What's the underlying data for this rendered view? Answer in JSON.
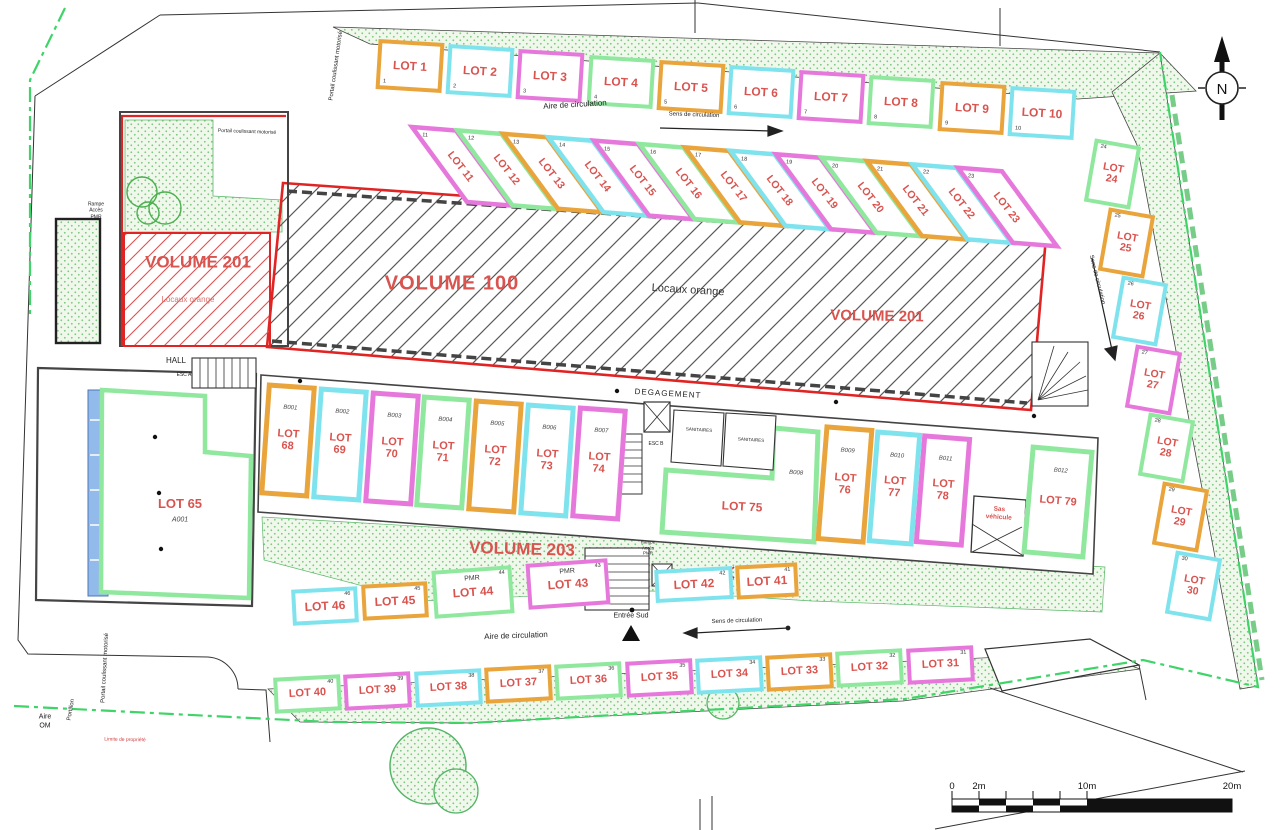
{
  "colors": {
    "orange": "#E9A43C",
    "cyan": "#7FE3EE",
    "magenta": "#E678DC",
    "green": "#8FE89E",
    "lot_text": "#D9534F",
    "red_line": "#E02424",
    "stipple_bg": "#F0F8EC",
    "stipple_dot": "#7CC87F",
    "boundary": "#3FD468",
    "blue": "#7FAEE8",
    "wall": "#3E3E3E"
  },
  "rows": {
    "top": {
      "items": [
        {
          "label": "LOT 1",
          "num": "1",
          "color": "orange"
        },
        {
          "label": "LOT 2",
          "num": "2",
          "color": "cyan"
        },
        {
          "label": "LOT 3",
          "num": "3",
          "color": "magenta"
        },
        {
          "label": "LOT 4",
          "num": "4",
          "color": "green"
        },
        {
          "label": "LOT 5",
          "num": "5",
          "color": "orange"
        },
        {
          "label": "LOT 6",
          "num": "6",
          "color": "cyan"
        },
        {
          "label": "LOT 7",
          "num": "7",
          "color": "magenta"
        },
        {
          "label": "LOT 8",
          "num": "8",
          "color": "green"
        },
        {
          "label": "LOT 9",
          "num": "9",
          "color": "orange"
        },
        {
          "label": "LOT 10",
          "num": "10",
          "color": "cyan"
        }
      ]
    },
    "diagonal": {
      "items": [
        {
          "label": "LOT 11",
          "num": "11",
          "color": "magenta"
        },
        {
          "label": "LOT 12",
          "num": "12",
          "color": "green"
        },
        {
          "label": "LOT 13",
          "num": "13",
          "color": "orange"
        },
        {
          "label": "LOT 14",
          "num": "14",
          "color": "cyan"
        },
        {
          "label": "LOT 15",
          "num": "15",
          "color": "magenta"
        },
        {
          "label": "LOT 16",
          "num": "16",
          "color": "green"
        },
        {
          "label": "LOT 17",
          "num": "17",
          "color": "orange"
        },
        {
          "label": "LOT 18",
          "num": "18",
          "color": "cyan"
        },
        {
          "label": "LOT 19",
          "num": "19",
          "color": "magenta"
        },
        {
          "label": "LOT 20",
          "num": "20",
          "color": "green"
        },
        {
          "label": "LOT 21",
          "num": "21",
          "color": "orange"
        },
        {
          "label": "LOT 22",
          "num": "22",
          "color": "cyan"
        },
        {
          "label": "LOT 23",
          "num": "23",
          "color": "magenta"
        }
      ]
    },
    "right": {
      "items": [
        {
          "label": "LOT 24",
          "num": "24",
          "color": "green"
        },
        {
          "label": "LOT 25",
          "num": "25",
          "color": "orange"
        },
        {
          "label": "LOT 26",
          "num": "26",
          "color": "cyan"
        },
        {
          "label": "LOT 27",
          "num": "27",
          "color": "magenta"
        },
        {
          "label": "LOT 28",
          "num": "28",
          "color": "green"
        },
        {
          "label": "LOT 29",
          "num": "29",
          "color": "orange"
        },
        {
          "label": "LOT 30",
          "num": "30",
          "color": "cyan"
        }
      ]
    },
    "bottom": {
      "items": [
        {
          "label": "LOT 40",
          "num": "40",
          "color": "green"
        },
        {
          "label": "LOT 39",
          "num": "39",
          "color": "magenta"
        },
        {
          "label": "LOT 38",
          "num": "38",
          "color": "cyan"
        },
        {
          "label": "LOT 37",
          "num": "37",
          "color": "orange"
        },
        {
          "label": "LOT 36",
          "num": "36",
          "color": "green"
        },
        {
          "label": "LOT 35",
          "num": "35",
          "color": "magenta"
        },
        {
          "label": "LOT 34",
          "num": "34",
          "color": "cyan"
        },
        {
          "label": "LOT 33",
          "num": "33",
          "color": "orange"
        },
        {
          "label": "LOT 32",
          "num": "32",
          "color": "green"
        },
        {
          "label": "LOT 31",
          "num": "31",
          "color": "magenta"
        }
      ]
    },
    "mid": {
      "items": [
        {
          "label": "LOT 46",
          "num": "46",
          "color": "cyan"
        },
        {
          "label": "LOT 45",
          "num": "45",
          "color": "orange"
        },
        {
          "label": "LOT 44",
          "num": "44",
          "color": "green",
          "pmr": "PMR"
        },
        {
          "label": "LOT 43",
          "num": "43",
          "color": "magenta",
          "pmr": "PMR"
        },
        {
          "label": "LOT 42",
          "num": "42",
          "color": "cyan"
        },
        {
          "label": "LOT 41",
          "num": "41",
          "color": "orange"
        }
      ]
    },
    "wing_a": {
      "items": [
        {
          "label": "LOT 68",
          "num": "68",
          "unit": "B001",
          "color": "orange"
        },
        {
          "label": "LOT 69",
          "num": "69",
          "unit": "B002",
          "color": "cyan"
        },
        {
          "label": "LOT 70",
          "num": "70",
          "unit": "B003",
          "color": "magenta"
        },
        {
          "label": "LOT 71",
          "num": "71",
          "unit": "B004",
          "color": "green"
        },
        {
          "label": "LOT 72",
          "num": "72",
          "unit": "B005",
          "color": "orange"
        },
        {
          "label": "LOT 73",
          "num": "73",
          "unit": "B006",
          "color": "cyan"
        },
        {
          "label": "LOT 74",
          "num": "74",
          "unit": "B007",
          "color": "magenta"
        }
      ]
    },
    "wing_b": {
      "items": [
        {
          "label": "LOT 75",
          "num": "75",
          "unit": "B008",
          "color": "green"
        },
        {
          "label": "LOT 76",
          "num": "76",
          "unit": "B009",
          "color": "orange"
        },
        {
          "label": "LOT 77",
          "num": "77",
          "unit": "B010",
          "color": "cyan"
        },
        {
          "label": "LOT 78",
          "num": "78",
          "unit": "B011",
          "color": "magenta"
        },
        {
          "label": "LOT 79",
          "num": "79",
          "unit": "B012",
          "color": "green"
        }
      ]
    },
    "lot65": {
      "label": "LOT 65",
      "unit": "A001",
      "color": "green"
    }
  },
  "labels": {
    "volume100": "VOLUME 100",
    "volume201_main": "VOLUME 201",
    "volume201_left": "VOLUME 201",
    "volume203": "VOLUME 203",
    "locaux_orange_main": "Locaux orange",
    "locaux_orange_left": "Locaux orange",
    "hall": "HALL",
    "esc_a": "ESC A",
    "esc_b": "ESC B",
    "degagement": "DEGAGEMENT",
    "sanitaires_1": "SANITAIRES",
    "sanitaires_2": "SANITAIRES",
    "aire_circulation_top": "Aire de circulation",
    "aire_circulation_bottom": "Aire de circulation",
    "sens_circulation_top": "Sens de circulation",
    "sens_circulation_right": "Sens de circulation",
    "sens_circulation_bottom": "Sens de circulation",
    "entree_sud": "Entrée Sud",
    "portail_top": "Portail coulissant motorisé",
    "portail_bottom": "Portail coulissant motorisé",
    "portail_court": "Portail coulissant motorisé",
    "portillon": "Portillon",
    "aire_om": "Aire\nOM",
    "limite_propriete": "Limite de propriété",
    "rampe_pmr_left": "Rampe\nAccès\nPMR",
    "rampe_pmr_south": "Rampe\nAccès\nPMR",
    "sas_vehicule": "Sas\nvéhicule",
    "north": "N"
  },
  "scale": {
    "ticks": [
      "0",
      "2m",
      "10m",
      "20m"
    ]
  }
}
